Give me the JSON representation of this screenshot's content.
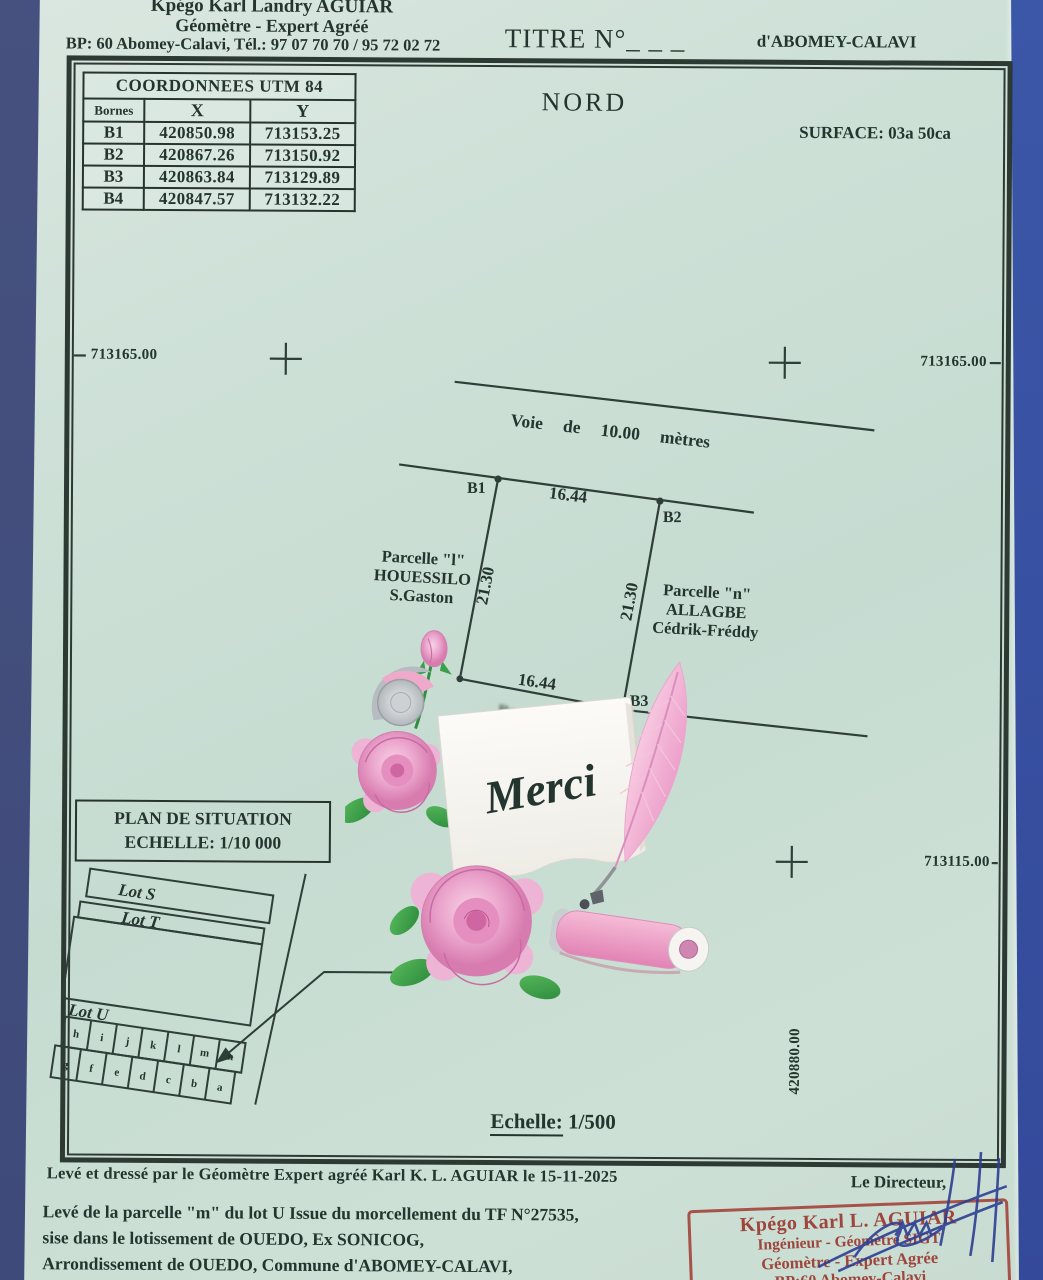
{
  "header": {
    "surveyor_name": "Kpégo Karl Landry AGUIAR",
    "surveyor_title": "Géomètre - Expert Agréé",
    "surveyor_contact": "BP: 60 Abomey-Calavi, Tél.: 97 07 70 70 / 95 72 02 72",
    "titre_label": "TITRE N°_ _ _",
    "location_label": "d'ABOMEY-CALAVI"
  },
  "coordinates_table": {
    "title": "COORDONNEES UTM 84",
    "columns": [
      "Bornes",
      "X",
      "Y"
    ],
    "rows": [
      [
        "B1",
        "420850.98",
        "713153.25"
      ],
      [
        "B2",
        "420867.26",
        "713150.92"
      ],
      [
        "B3",
        "420863.84",
        "713129.89"
      ],
      [
        "B4",
        "420847.57",
        "713132.22"
      ]
    ]
  },
  "plan": {
    "north_label": "NORD",
    "surface_label": "SURFACE: 03a 50ca",
    "grid_top_left": "713165.00",
    "grid_top_right": "713165.00",
    "grid_mid_right": "713115.00",
    "grid_bottom_vertical": "420880.00",
    "road_label": "Voie de 10.00 mètres",
    "corner_b1": "B1",
    "corner_b2": "B2",
    "corner_b3": "B3",
    "dim_top": "16.44",
    "dim_bottom": "16.44",
    "dim_left": "21.30",
    "dim_right": "21.30",
    "parcel_left": {
      "line1": "Parcelle \"l\"",
      "line2": "HOUESSILO",
      "line3": "S.Gaston"
    },
    "parcel_right": {
      "line1": "Parcelle \"n\"",
      "line2": "ALLAGBE",
      "line3": "Cédrik-Fréddy"
    },
    "covered_label": "Parcelle",
    "scale_label": "Echelle:",
    "scale_value": "1/500"
  },
  "situation": {
    "title_line1": "PLAN DE SITUATION",
    "title_line2": "ECHELLE: 1/10 000",
    "lot_s": "Lot S",
    "lot_t": "Lot T",
    "lot_u": "Lot U",
    "cells_top": [
      "h",
      "i",
      "j",
      "k",
      "l",
      "m",
      "n"
    ],
    "cells_bottom": [
      "g",
      "f",
      "e",
      "d",
      "c",
      "b",
      "a"
    ]
  },
  "decoration": {
    "merci_text": "Merci"
  },
  "footer": {
    "attestation": "Levé et dressé  par  le  Géomètre  Expert agréé   Karl K. L. AGUIAR  le 15-11-2025",
    "director_label": "Le Directeur,",
    "description_lines": [
      "Levé de la parcelle \"m\" du lot U Issue du morcellement du TF N°27535,",
      "sise dans le lotissement de OUEDO, Ex SONICOG,",
      "Arrondissement de OUEDO, Commune d'ABOMEY-CALAVI,",
      "Levé pour Madame JOHNSON, Light Lena Pintsiwa"
    ],
    "stamp": {
      "line1": "Kpégo Karl L. AGUIAR",
      "line2": "Ingénieur - Géomètre SIGT",
      "line3": "Géomètre - Expert Agrée",
      "line4": "BP:60 Abomey-Calavi"
    }
  },
  "colors": {
    "page_bg": "#cbdfd5",
    "ink": "#24342e",
    "side_blue_left": "#424e7d",
    "side_blue_right": "#3a53a4",
    "stamp_red": "#9e453c",
    "signature_blue": "#2e3f92",
    "rose_pink": "#e79cc6",
    "leaf_green": "#3ca04a",
    "feather_pink": "#f0b3d3",
    "scroll_white": "#f7f5f0"
  }
}
